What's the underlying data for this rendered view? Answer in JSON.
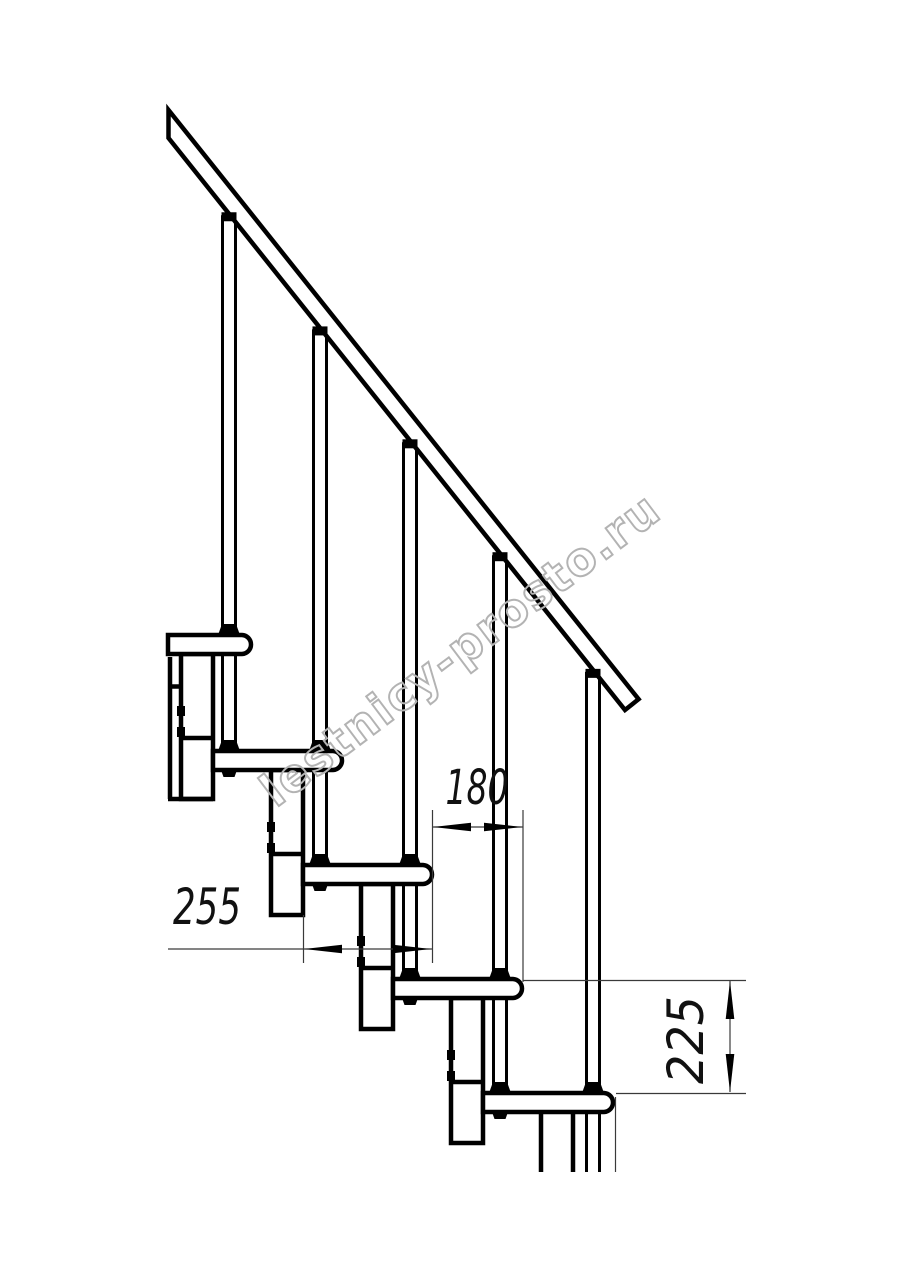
{
  "watermark": {
    "text": "lestnicy-prosto.ru",
    "stroke_color": "#b3b3b3"
  },
  "dimensions": {
    "tread_offset": {
      "label": "180",
      "value": 180
    },
    "tread_depth": {
      "label": "255",
      "value": 255
    },
    "step_rise": {
      "label": "225",
      "value": 225
    }
  },
  "drawing": {
    "background": "#ffffff",
    "line_color": "#000000",
    "thin_line_color": "#3a3a3a",
    "rail": {
      "x0": 169,
      "underside_y0": 138,
      "top_y0": 110,
      "slope": 1.2544,
      "left_cut_x": 168.5,
      "end_upper": [
        638.6,
        699.2
      ],
      "end_lower": [
        625,
        710
      ]
    },
    "tread_height": 19,
    "rod_half_width": 6.5,
    "module_width": 32,
    "cut_bottom_y": 1172,
    "steps": [
      {
        "tread": {
          "left": 168,
          "right": 251,
          "top": 635
        },
        "rod_x": 229,
        "module": {
          "x": 181,
          "top": 654,
          "bottom": 799,
          "divider": 738,
          "open": false
        }
      },
      {
        "tread": {
          "left": 213,
          "right": 342,
          "top": 751
        },
        "rod_x": 320,
        "module": {
          "x": 271,
          "top": 770,
          "bottom": 915,
          "divider": 854,
          "open": false
        }
      },
      {
        "tread": {
          "left": 303,
          "right": 432,
          "top": 865
        },
        "rod_x": 410,
        "module": {
          "x": 361,
          "top": 884,
          "bottom": 1029,
          "divider": 968,
          "open": false
        }
      },
      {
        "tread": {
          "left": 393,
          "right": 522,
          "top": 979
        },
        "rod_x": 500,
        "module": {
          "x": 451,
          "top": 998,
          "bottom": 1143,
          "divider": 1082,
          "open": false
        }
      },
      {
        "tread": {
          "left": 483,
          "right": 613,
          "top": 1093
        },
        "rod_x": 593,
        "module": {
          "x": 541,
          "top": 1112,
          "bottom": 1172,
          "divider": null,
          "open": true
        }
      }
    ]
  }
}
